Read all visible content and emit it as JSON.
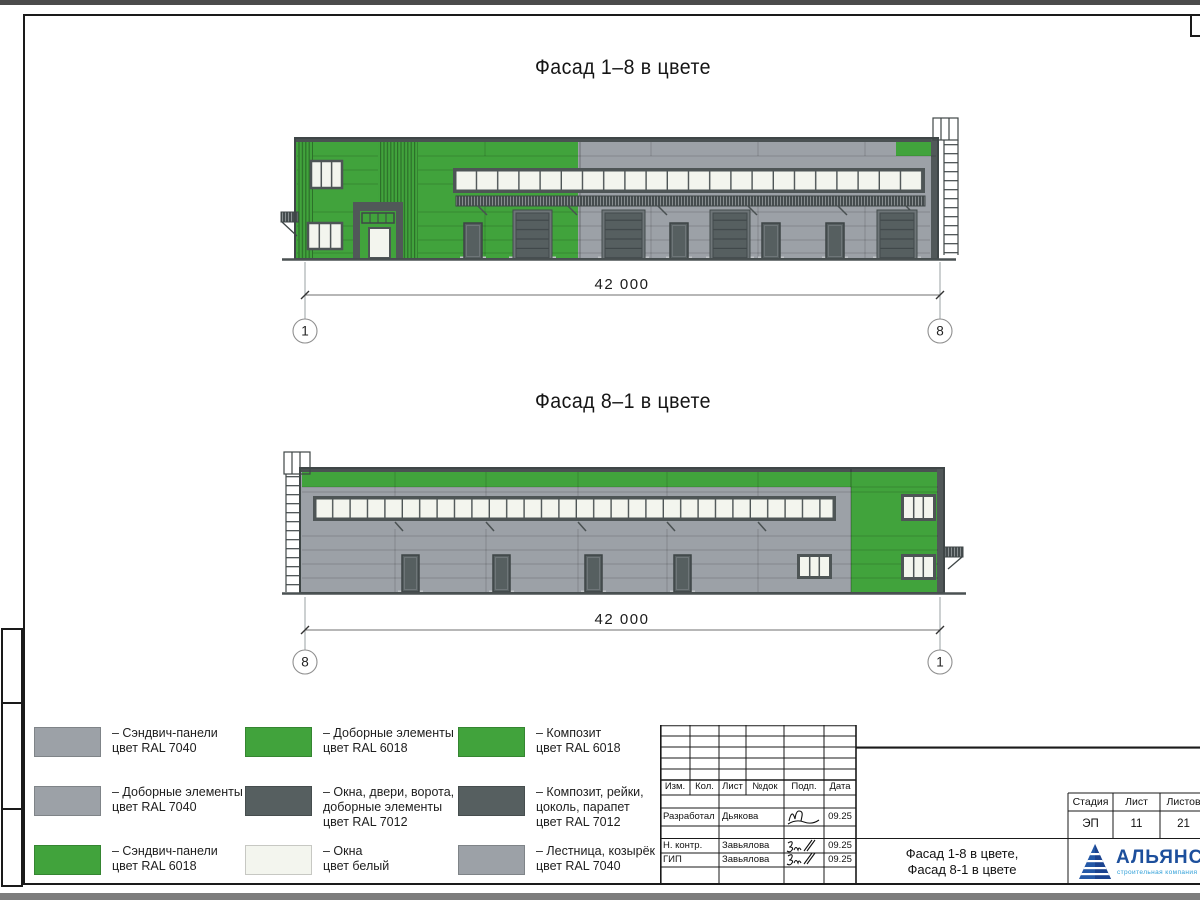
{
  "facades": {
    "f1": {
      "title": "Фасад 1–8 в цвете",
      "dimension": "42 000",
      "axis_left": "1",
      "axis_right": "8"
    },
    "f2": {
      "title": "Фасад 8–1 в цвете",
      "dimension": "42 000",
      "axis_left": "8",
      "axis_right": "1"
    }
  },
  "legend": {
    "items": [
      {
        "swatch": "grey",
        "label": "– Сэндвич-панели\nцвет RAL 7040"
      },
      {
        "swatch": "grey",
        "label": "– Доборные элементы\nцвет RAL 7040"
      },
      {
        "swatch": "green",
        "label": "– Сэндвич-панели\nцвет RAL 6018"
      },
      {
        "swatch": "green",
        "label": "– Доборные элементы\nцвет RAL 6018"
      },
      {
        "swatch": "dark",
        "label": "– Окна, двери, ворота,\nдоборные элементы\nцвет RAL 7012"
      },
      {
        "swatch": "window",
        "label": "– Окна\nцвет белый"
      },
      {
        "swatch": "green",
        "label": "– Композит\nцвет RAL 6018"
      },
      {
        "swatch": "dark",
        "label": "– Композит, рейки,\nцоколь, парапет\nцвет RAL 7012"
      },
      {
        "swatch": "grey",
        "label": "– Лестница, козырёк\nцвет RAL 7040"
      }
    ]
  },
  "colors": {
    "green": "#41a33c",
    "grey": "#9ca1a7",
    "dark": "#565f60",
    "window": "#f3f5ee",
    "logo_blue": "#1d4f9c",
    "logo_cyan": "#2f9fd8"
  },
  "titleblock": {
    "rev_headers": [
      "Изм.",
      "Кол.",
      "Лист",
      "№док",
      "Подп.",
      "Дата"
    ],
    "rows": [
      {
        "role": "Разработал",
        "name": "Дьякова",
        "date": "09.25"
      },
      {
        "role": "Н. контр.",
        "name": "Завьялова",
        "date": "09.25"
      },
      {
        "role": "ГИП",
        "name": "Завьялова",
        "date": "09.25"
      }
    ],
    "doc_title": "Фасад 1-8 в цвете,\nФасад 8-1 в цвете",
    "stage_table": {
      "headers": [
        "Стадия",
        "Лист",
        "Листов"
      ],
      "values": [
        "ЭП",
        "11",
        "21"
      ]
    },
    "logo": {
      "name": "АЛЬЯНС",
      "subtitle": "строительная компания"
    }
  }
}
